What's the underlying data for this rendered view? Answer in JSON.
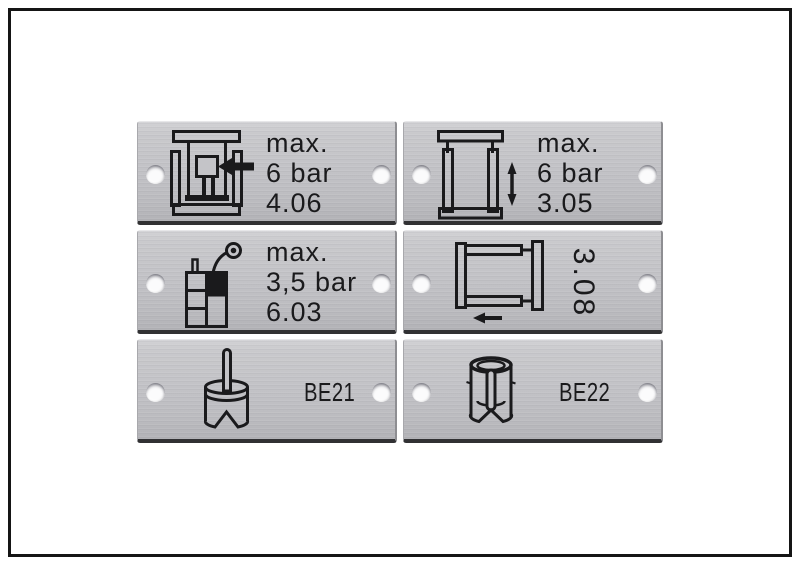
{
  "scene": {
    "description_labels_total": "6",
    "frame_color": "#151515",
    "background_color": "#ffffff"
  },
  "colors": {
    "plate_metal_light": "#d2d2d5",
    "plate_metal_mid": "#c3c3c7",
    "plate_metal_dark": "#b2b2b6",
    "plate_edge_shadow": "#313133",
    "engraving_text": "#1a1a1c",
    "hole_fill": "#fbfbfc"
  },
  "plates": [
    {
      "id": "plate-4-06",
      "icon": "press-ram-arrow-icon",
      "lines": [
        "max.",
        "6 bar",
        "4.06"
      ]
    },
    {
      "id": "plate-3-05",
      "icon": "clamp-vertical-arrow-icon",
      "lines": [
        "max.",
        "6 bar",
        "3.05"
      ]
    },
    {
      "id": "plate-6-03",
      "icon": "lubricator-gauge-icon",
      "lines": [
        "max.",
        "3,5 bar",
        "6.03"
      ]
    },
    {
      "id": "plate-3-08",
      "icon": "clamp-horizontal-arrow-icon",
      "rotated_label": "3.08"
    },
    {
      "id": "plate-be21",
      "icon": "cylinder-pin-vblock-icon",
      "label": "BE21"
    },
    {
      "id": "plate-be22",
      "icon": "cylinder-sleeve-cutaway-icon",
      "label": "BE22"
    }
  ]
}
